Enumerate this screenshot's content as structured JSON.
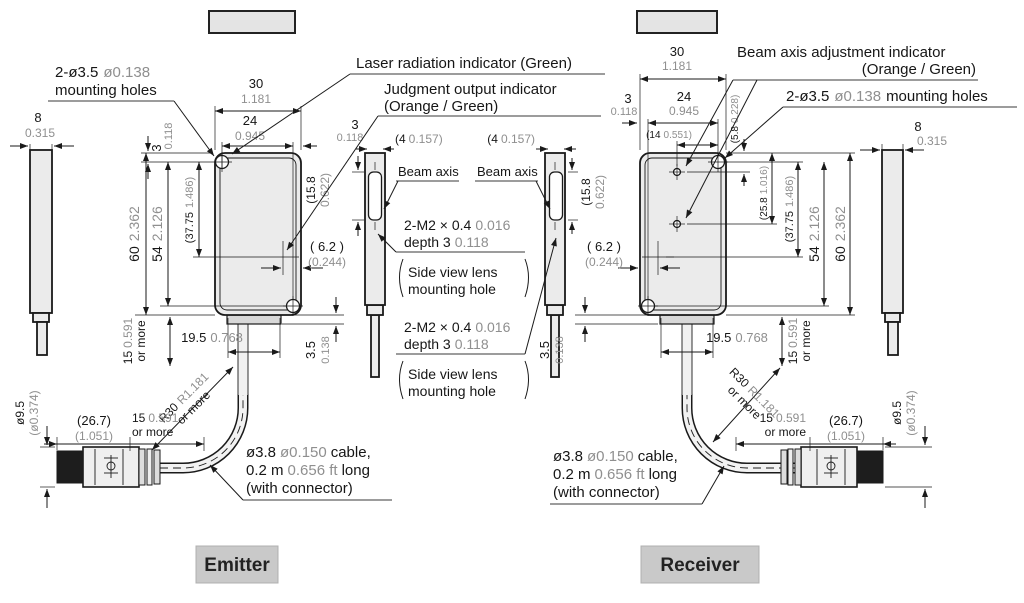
{
  "title_boxes": {
    "left": "",
    "right": ""
  },
  "section_labels": {
    "emitter": "Emitter",
    "receiver": "Receiver"
  },
  "callouts": {
    "laser": "Laser radiation indicator (Green)",
    "judgment_line1": "Judgment output indicator",
    "judgment_line2": "(Orange / Green)",
    "beam_adjust_line1": "Beam axis adjustment indicator",
    "beam_adjust_line2": "(Orange / Green)",
    "mounting_mm": "2-ø3.5",
    "mounting_in": "ø0.138",
    "mounting_text": "mounting holes",
    "beam_axis": "Beam axis",
    "m2_line1_mm": "2-M2 × 0.4",
    "m2_line1_in": "0.016",
    "m2_line2_mm": "depth 3",
    "m2_line2_in": "0.118",
    "side_lens_line1": "Side view lens",
    "side_lens_line2": "mounting hole",
    "cable_line1_mm": "ø3.8",
    "cable_line1_in": "ø0.150",
    "cable_line1_text": "cable,",
    "cable_line2_mm": "0.2 m",
    "cable_line2_in": "0.656 ft",
    "cable_line2_text": "long",
    "cable_line3": "(with connector)"
  },
  "dims": {
    "w8_mm": "8",
    "w8_in": "0.315",
    "w30_mm": "30",
    "w30_in": "1.181",
    "w24_mm": "24",
    "w24_in": "0.945",
    "t3_mm": "3",
    "t3_in": "0.118",
    "h60_mm": "60",
    "h60_in": "2.362",
    "h54_mm": "54",
    "h54_in": "2.126",
    "h3775_mm": "(37.75",
    "h3775_in": "1.486)",
    "h158_mm": "(15.8",
    "h158_in": "0.622)",
    "g62_mm": "( 6.2 )",
    "g62_in": "(0.244)",
    "w195_mm": "19.5",
    "w195_in": "0.768",
    "h35_mm": "3.5",
    "h35_in": "0.138",
    "m15_mm": "15",
    "m15_in": "0.591",
    "m15_text": "or more",
    "w4_mm": "(4",
    "w4_in": "0.157)",
    "w14_mm": "(14",
    "w14_in": "0.551)",
    "h58_mm": "(5.8",
    "h58_in": "0.228)",
    "h258_mm": "(25.8",
    "h258_in": "1.016)",
    "c267_mm": "(26.7)",
    "c267_in": "(1.051)",
    "c95_mm": "ø9.5",
    "c95_in": "(ø0.374)",
    "r30_mm": "R30",
    "r30_in": "R1.181",
    "r30_text": "or more"
  }
}
